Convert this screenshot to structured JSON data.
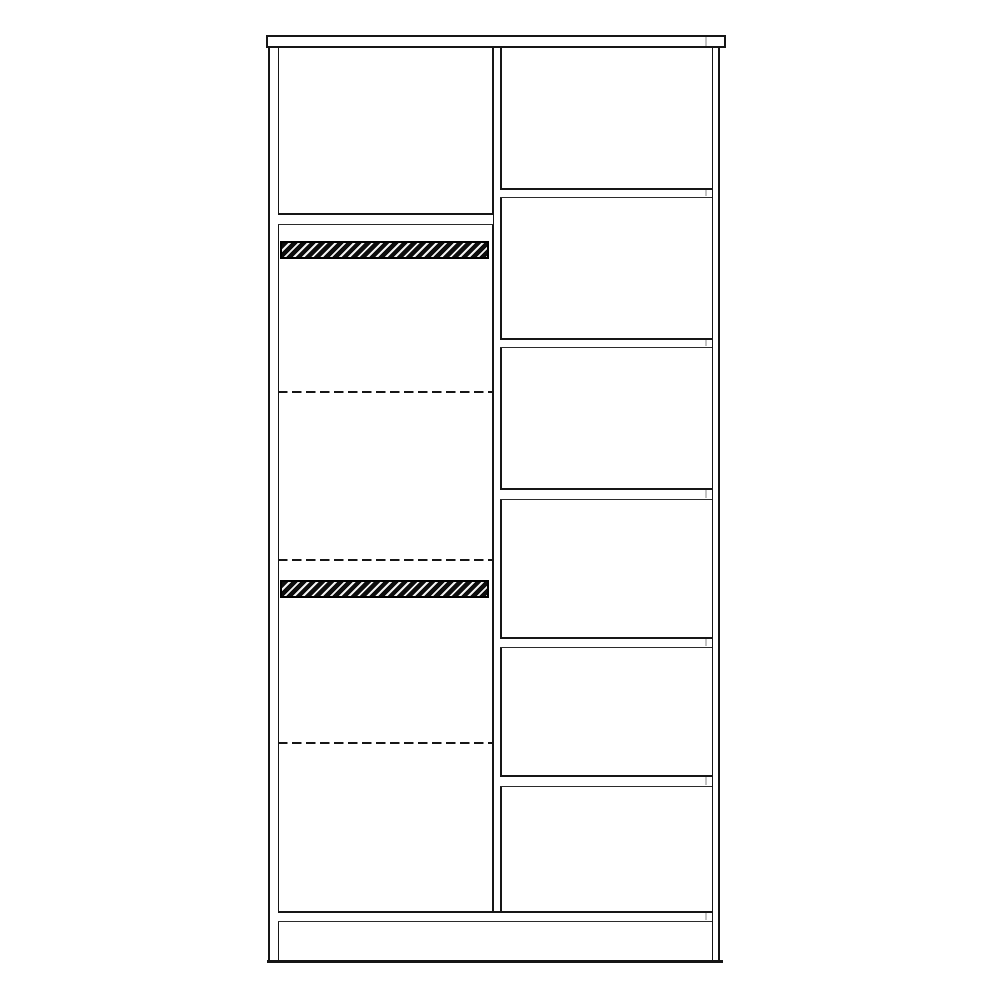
{
  "canvas": {
    "width": 1000,
    "height": 1000,
    "background": "#ffffff"
  },
  "colors": {
    "line": "#161616",
    "line_thin": "#2b2b2b",
    "hatch_dark": "#0d0d0d",
    "hatch_light": "#f2f2f2",
    "joint": "#c2c2c2",
    "fill": "#ffffff"
  },
  "diagram": {
    "name": "wardrobe-front-elevation-line-drawing",
    "description": "Black-on-white technical front view of a two-section wardrobe: left section with a fixed shelf, two hatched hanging rails and three dashed adjustable shelf positions; right section with five shelves forming six compartments; top panel, center divider, bottom board and plinth.",
    "elements": [
      {
        "name": "top-panel",
        "type": "board-rect",
        "x": 266,
        "y": 35,
        "w": 460,
        "h": 13
      },
      {
        "name": "top-panel-joint-mark",
        "type": "vline",
        "x": 705,
        "y": 37,
        "h": 9,
        "t": 1.5,
        "color": "joint"
      },
      {
        "name": "left-side-panel-outer-edge",
        "type": "vline",
        "x": 268,
        "y": 47,
        "h": 915,
        "t": 2
      },
      {
        "name": "left-side-panel-inner-edge",
        "type": "vline",
        "x": 278,
        "y": 47,
        "h": 915,
        "t": 1.3
      },
      {
        "name": "right-side-panel-inner-edge",
        "type": "vline",
        "x": 712,
        "y": 47,
        "h": 915,
        "t": 1.3
      },
      {
        "name": "right-side-panel-outer-edge",
        "type": "vline",
        "x": 718,
        "y": 47,
        "h": 915,
        "t": 2.2
      },
      {
        "name": "center-divider-left-edge",
        "type": "vline",
        "x": 492,
        "y": 47,
        "h": 865,
        "t": 2
      },
      {
        "name": "center-divider-right-edge",
        "type": "vline",
        "x": 500,
        "y": 47,
        "h": 865,
        "t": 1.5
      },
      {
        "name": "left-top-shelf",
        "type": "board",
        "x": 278,
        "y": 213,
        "w": 215,
        "h": 12,
        "t1": 2,
        "t2": 1.2
      },
      {
        "name": "upper-hanging-rail",
        "type": "hatch",
        "x": 280,
        "y": 241,
        "w": 209,
        "h": 18
      },
      {
        "name": "left-adjustable-shelf-position-1",
        "type": "dashed",
        "x": 278,
        "y": 391,
        "w": 214,
        "t": 2
      },
      {
        "name": "left-adjustable-shelf-position-2",
        "type": "dashed",
        "x": 278,
        "y": 559,
        "w": 214,
        "t": 2
      },
      {
        "name": "lower-hanging-rail",
        "type": "hatch",
        "x": 280,
        "y": 580,
        "w": 209,
        "h": 18
      },
      {
        "name": "left-adjustable-shelf-position-3",
        "type": "dashed",
        "x": 278,
        "y": 742,
        "w": 214,
        "t": 2
      },
      {
        "name": "right-shelf-1",
        "type": "board",
        "x": 500,
        "y": 188,
        "w": 212,
        "h": 10,
        "t1": 2,
        "t2": 1.2
      },
      {
        "name": "right-shelf-1-joint-mark",
        "type": "vline",
        "x": 705,
        "y": 190,
        "h": 6,
        "t": 1.5,
        "color": "joint"
      },
      {
        "name": "right-shelf-2",
        "type": "board",
        "x": 500,
        "y": 338,
        "w": 212,
        "h": 10,
        "t1": 2,
        "t2": 1.2
      },
      {
        "name": "right-shelf-2-joint-mark",
        "type": "vline",
        "x": 705,
        "y": 340,
        "h": 6,
        "t": 1.5,
        "color": "joint"
      },
      {
        "name": "right-shelf-3",
        "type": "board",
        "x": 500,
        "y": 488,
        "w": 212,
        "h": 12,
        "t1": 2,
        "t2": 1.2
      },
      {
        "name": "right-shelf-3-joint-mark",
        "type": "vline",
        "x": 705,
        "y": 490,
        "h": 8,
        "t": 1.5,
        "color": "joint"
      },
      {
        "name": "right-shelf-4",
        "type": "board",
        "x": 500,
        "y": 637,
        "w": 212,
        "h": 11,
        "t1": 2,
        "t2": 1.2
      },
      {
        "name": "right-shelf-4-joint-mark",
        "type": "vline",
        "x": 705,
        "y": 639,
        "h": 7,
        "t": 1.5,
        "color": "joint"
      },
      {
        "name": "right-shelf-5",
        "type": "board",
        "x": 500,
        "y": 775,
        "w": 212,
        "h": 12,
        "t1": 2,
        "t2": 1.2
      },
      {
        "name": "right-shelf-5-joint-mark",
        "type": "vline",
        "x": 705,
        "y": 777,
        "h": 8,
        "t": 1.5,
        "color": "joint"
      },
      {
        "name": "bottom-shelf-board",
        "type": "board",
        "x": 278,
        "y": 911,
        "w": 434,
        "h": 11,
        "t1": 2,
        "t2": 1.2
      },
      {
        "name": "bottom-board-joint-mark",
        "type": "vline",
        "x": 705,
        "y": 913,
        "h": 7,
        "t": 1.5,
        "color": "joint"
      },
      {
        "name": "base-bottom-edge",
        "type": "hline",
        "x": 267,
        "y": 960,
        "w": 456,
        "t": 2.5
      }
    ]
  }
}
